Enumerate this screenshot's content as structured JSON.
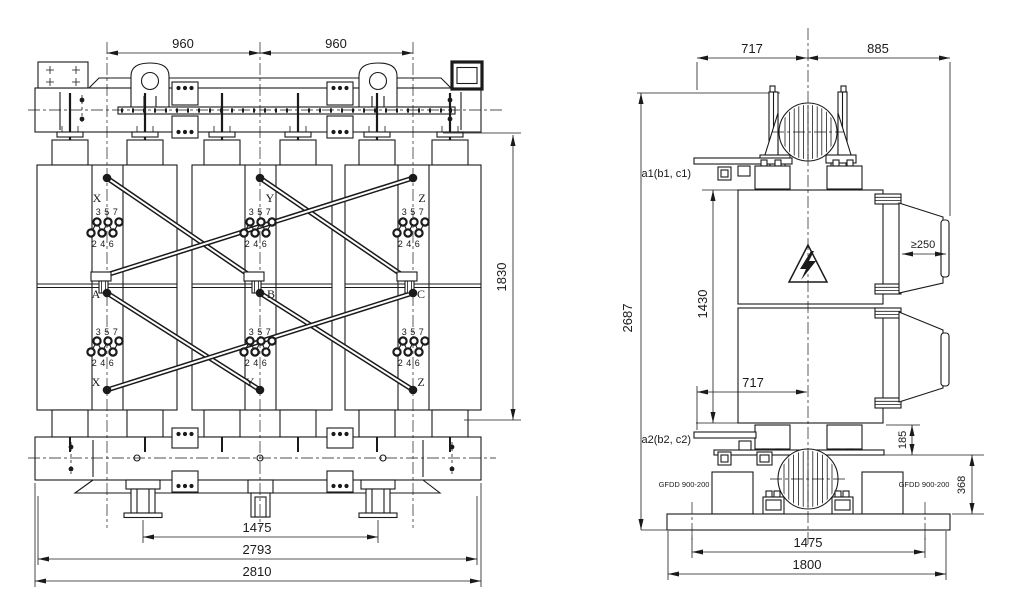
{
  "front_view": {
    "dims": {
      "top_left": "960",
      "top_right": "960",
      "height": "1830",
      "wheel_spacing": "1475",
      "base_length": "2793",
      "overall_width": "2810"
    },
    "phases": [
      {
        "top": "X",
        "middle": "A",
        "bottom": "X",
        "tap_odd": "3 5 7",
        "tap_even": "2 4 6"
      },
      {
        "top": "Y",
        "middle": "B",
        "bottom": "Y",
        "tap_odd": "3 5 7",
        "tap_even": "2 4 6"
      },
      {
        "top": "Z",
        "middle": "C",
        "bottom": "Z",
        "tap_odd": "3 5 7",
        "tap_even": "2 4 6"
      }
    ]
  },
  "side_view": {
    "dims": {
      "top_left": "717",
      "top_right": "885",
      "overall_height": "2687",
      "body_height": "1430",
      "bottom_offset": "717",
      "duct_depth": "≥250",
      "clamp": "185",
      "base_height": "368",
      "wheel_spacing": "1475",
      "base_width": "1800"
    },
    "labels": {
      "lv_top": "a1(b1, c1)",
      "lv_bottom": "a2(b2, c2)",
      "fan_left": "GFDD 900-200",
      "fan_right": "GFDD 900-200"
    }
  },
  "colors": {
    "line": "#1a1a1a",
    "background": "#ffffff"
  }
}
